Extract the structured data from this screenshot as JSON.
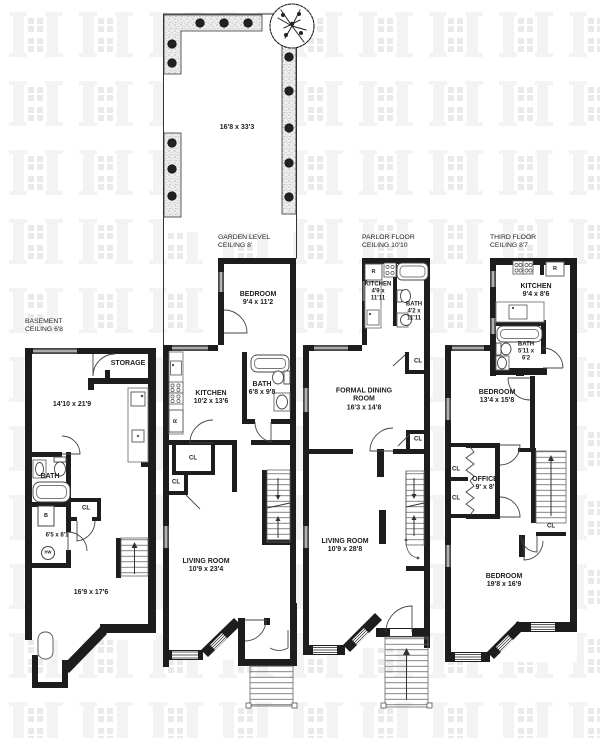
{
  "yard": {
    "dims": "16'8 x 33'3"
  },
  "fixtures": {
    "refrigerator": "R",
    "boiler": "B",
    "hot_water": "HW"
  },
  "floors": {
    "basement": {
      "title": "BASEMENT",
      "ceiling": "CEILING 6'8",
      "storage": "STORAGE",
      "main_dims": "14'10 x 21'9",
      "bath": "BATH",
      "closet": "CL",
      "mech_dims": "6'5 x 8'1",
      "rec_dims": "16'9 x 17'6"
    },
    "garden": {
      "title": "GARDEN LEVEL",
      "ceiling": "CEILING 8'",
      "bedroom": {
        "name": "BEDROOM",
        "dims": "9'4 x 11'2"
      },
      "kitchen": {
        "name": "KITCHEN",
        "dims": "10'2 x 13'6"
      },
      "bath": {
        "name": "BATH",
        "dims": "6'8 x 9'8"
      },
      "closet1": "CL",
      "closet2": "CL",
      "living": {
        "name": "LIVING ROOM",
        "dims": "10'9 x 23'4"
      }
    },
    "parlor": {
      "title": "PARLOR FLOOR",
      "ceiling": "CEILING 10'10",
      "kitchen": {
        "name": "KITCHEN",
        "dims1": "4'9 x",
        "dims2": "11'11"
      },
      "bath": {
        "name": "BATH",
        "dims1": "4'2 x",
        "dims2": "11'11"
      },
      "dining": {
        "name1": "FORMAL DINING",
        "name2": "ROOM",
        "dims": "16'3 x 14'8"
      },
      "closet1": "CL",
      "closet2": "CL",
      "living": {
        "name": "LIVING ROOM",
        "dims": "10'9 x 28'8"
      }
    },
    "third": {
      "title": "THIRD FLOOR",
      "ceiling": "CEILING 8'7",
      "kitchen": {
        "name": "KITCHEN",
        "dims": "9'4 x 8'6"
      },
      "bath": {
        "name": "BATH",
        "dims1": "5'11 x",
        "dims2": "6'2"
      },
      "bedroom1": {
        "name": "BEDROOM",
        "dims": "13'4 x 15'8"
      },
      "office": {
        "name": "OFFICE",
        "dims": "9' x 8'"
      },
      "closet1": "CL",
      "closet2": "CL",
      "closet3": "CL",
      "bedroom2": {
        "name": "BEDROOM",
        "dims": "19'8 x 16'9"
      }
    }
  }
}
